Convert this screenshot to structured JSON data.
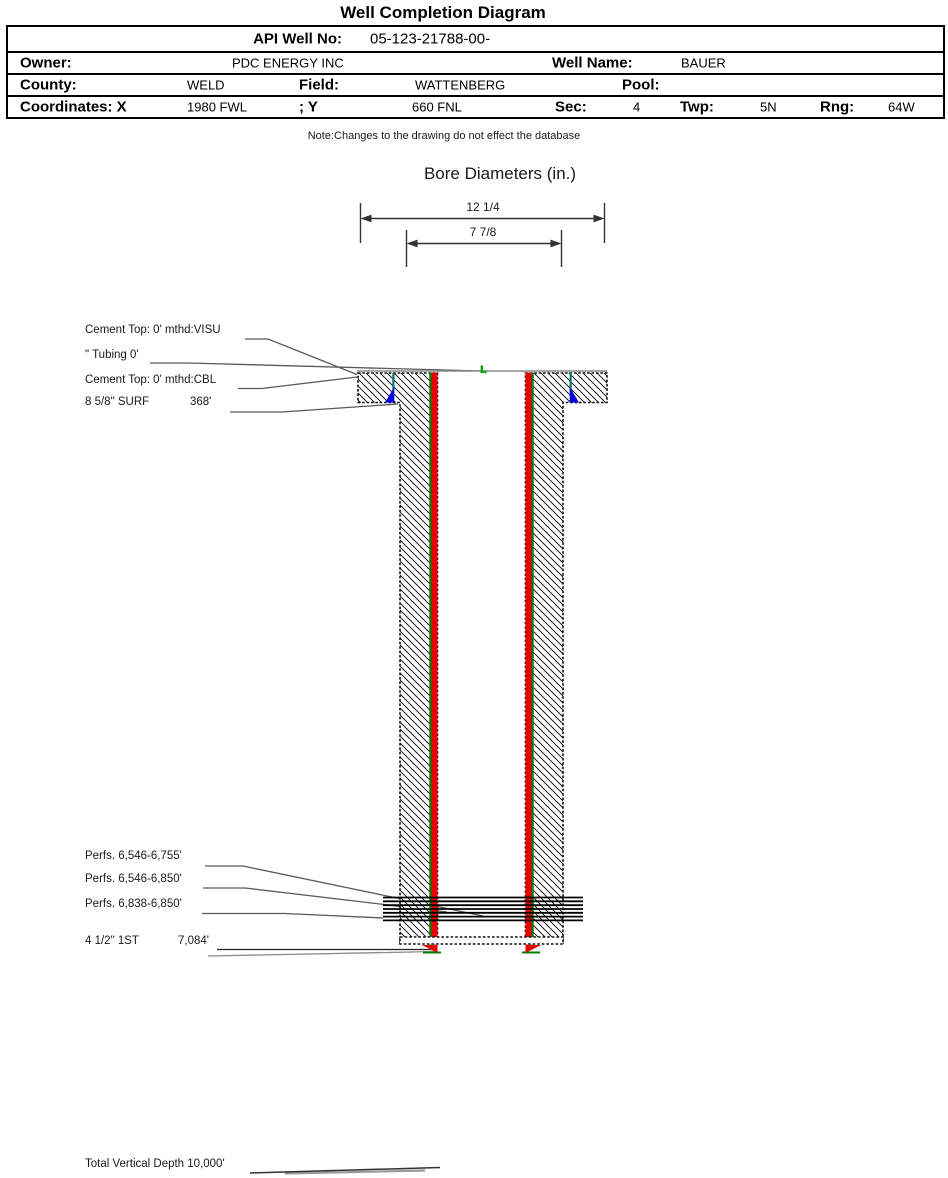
{
  "header": {
    "title": "Well Completion Diagram"
  },
  "info_table": {
    "api_label": "API Well No:",
    "api_value": "05-123-21788-00-",
    "owner_label": "Owner:",
    "owner_value": "PDC ENERGY INC",
    "well_name_label": "Well Name:",
    "well_name_value": "BAUER",
    "county_label": "County:",
    "county_value": "WELD",
    "field_label": "Field:",
    "field_value": "WATTENBERG",
    "pool_label": "Pool:",
    "pool_value": "",
    "coordinates_label": "Coordinates: X",
    "x_value": "1980 FWL",
    "y_label": "; Y",
    "y_value": "660 FNL",
    "sec_label": "Sec:",
    "sec_value": "4",
    "twp_label": "Twp:",
    "twp_value": "5N",
    "rng_label": "Rng:",
    "rng_value": "64W"
  },
  "note": "Note:Changes to the drawing do not effect the database",
  "bore_diameters": {
    "title": "Bore Diameters (in.)",
    "outer_label": "12 1/4",
    "inner_label": "7 7/8"
  },
  "annotations": {
    "cement_top_visu": "Cement Top: 0' mthd:VISU",
    "tubing": "\" Tubing 0'",
    "cement_top_cbl": "Cement Top: 0' mthd:CBL",
    "surface_casing": "8 5/8\" SURF",
    "surface_casing_depth": "368'",
    "perfs_1": "Perfs. 6,546-6,755'",
    "perfs_2": "Perfs. 6,546-6,850'",
    "perfs_3": "Perfs. 6,838-6,850'",
    "production_casing": "4 1/2\" 1ST",
    "production_casing_depth": "7,084'",
    "total_vertical_depth": "Total Vertical Depth 10,000'"
  },
  "colors": {
    "casing_red": "#e60000",
    "cement_blue": "#0000e0",
    "tubing_green": "#00a500",
    "liner_green": "#008000",
    "hanger_teal": "#007878"
  }
}
